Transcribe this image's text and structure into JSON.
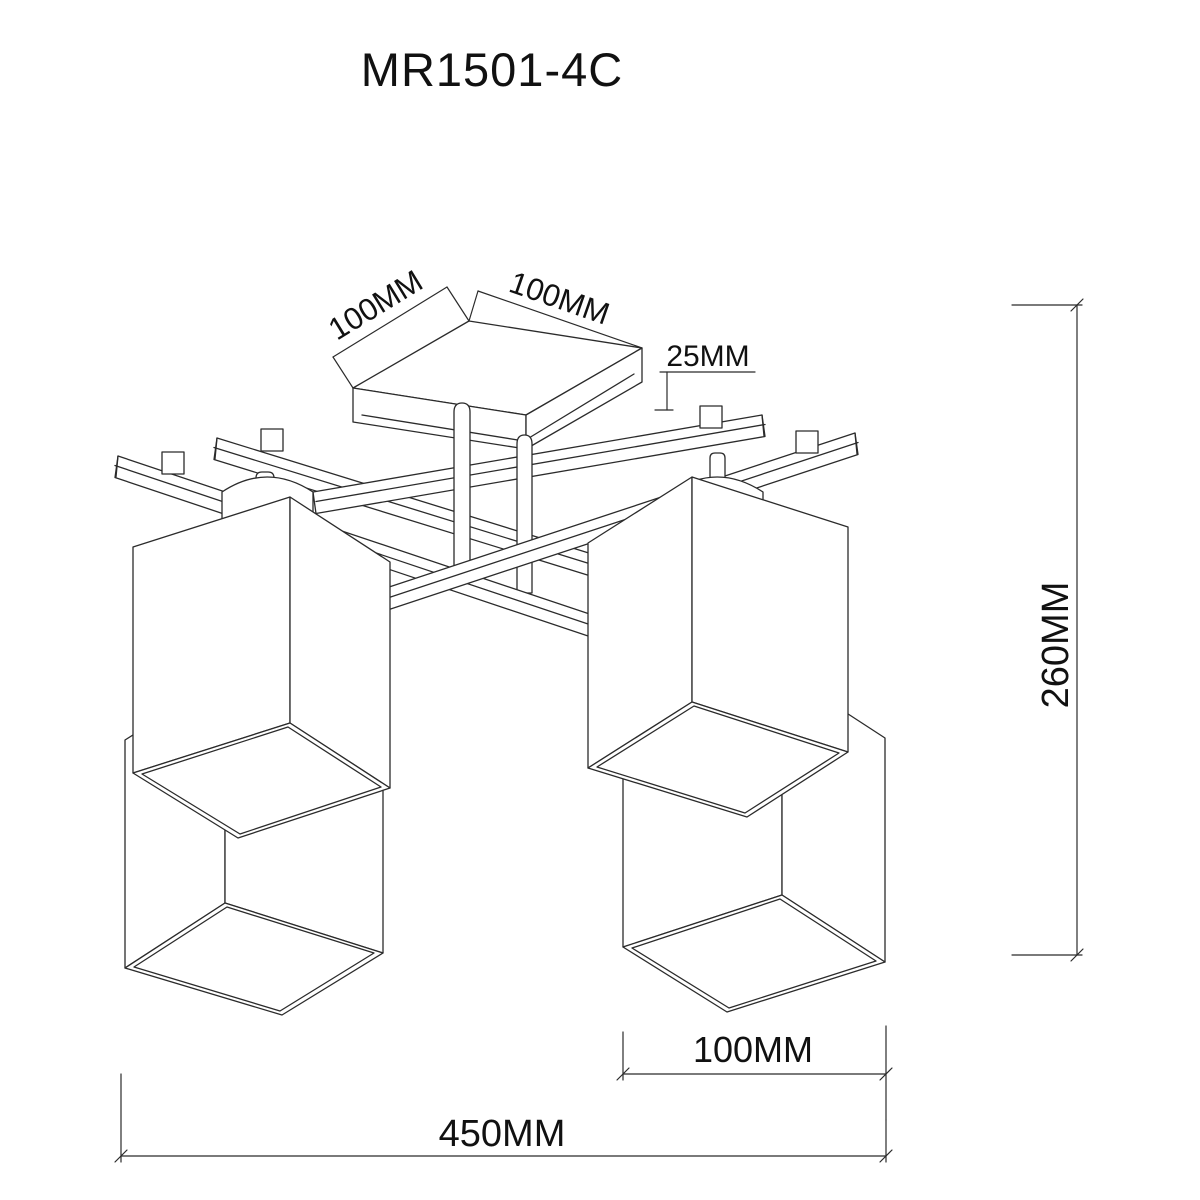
{
  "title": "MR1501-4C",
  "dimensions": {
    "canopy_left": "100MM",
    "canopy_right": "100MM",
    "canopy_thickness": "25MM",
    "overall_height": "260MM",
    "shade_width": "100MM",
    "overall_width": "450MM"
  }
}
